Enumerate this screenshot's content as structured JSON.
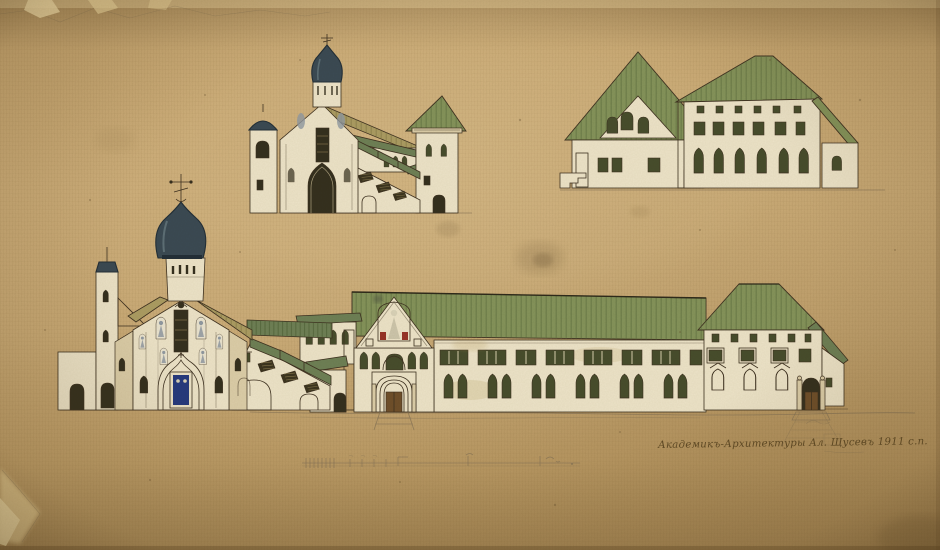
{
  "artwork": {
    "kind": "watercolor-architectural-elevation-sketches-on-aged-paper",
    "drawings": [
      "church-side-view-sketch",
      "service-building-sketch",
      "monastery-main-elevation"
    ]
  },
  "signature": {
    "text": "Академикъ-Архитектуры Ал. Щусевъ 1911 с.п."
  },
  "colors": {
    "paper": "#c7a772",
    "paper_light": "#d8bd8a",
    "paper_dark": "#a6895a",
    "ink": "#3e3120",
    "pencil": "#857355",
    "wall": "#ece3c8",
    "wall_shade": "#dbcda8",
    "roof": "#84935a",
    "roof_teal": "#6e8055",
    "roof_tan": "#ab9c62",
    "roof_stripe": "#5a6a3c",
    "dome": "#3b4a53",
    "dome_dark": "#232f37",
    "dome_light": "#64767d",
    "window": "#474d2c",
    "opening": "#35301e",
    "door": "#6f4f2a",
    "fresco_blue": "#3a50a8",
    "fresco_red": "#973427",
    "figure_grey": "#9099a1"
  }
}
